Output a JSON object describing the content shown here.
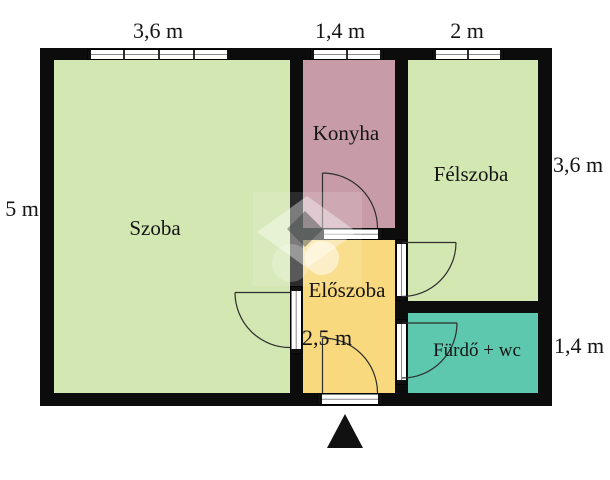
{
  "floorplan": {
    "type": "apartment-floor-plan",
    "rooms": [
      {
        "id": "szoba",
        "label": "Szoba",
        "color": "#d3e7b2"
      },
      {
        "id": "konyha",
        "label": "Konyha",
        "color": "#c79ca8"
      },
      {
        "id": "felszoba",
        "label": "Félszoba",
        "color": "#d3e7b2"
      },
      {
        "id": "eloszoba",
        "label": "Előszoba",
        "color": "#f8d97e"
      },
      {
        "id": "furdo",
        "label": "Fürdő + wc",
        "color": "#5dc8ad"
      }
    ],
    "dimensions": {
      "top_left": "3,6 m",
      "top_middle": "1,4 m",
      "top_right": "2 m",
      "left": "5 m",
      "right_upper": "3,6 m",
      "right_lower": "1,4 m",
      "eloszoba_width": "2,5 m"
    },
    "colors": {
      "wall": "#0c0c0c",
      "background": "#ffffff",
      "text": "#151515",
      "entrance_marker": "#111111"
    },
    "icons": {
      "entrance": "triangle-up-icon"
    }
  }
}
